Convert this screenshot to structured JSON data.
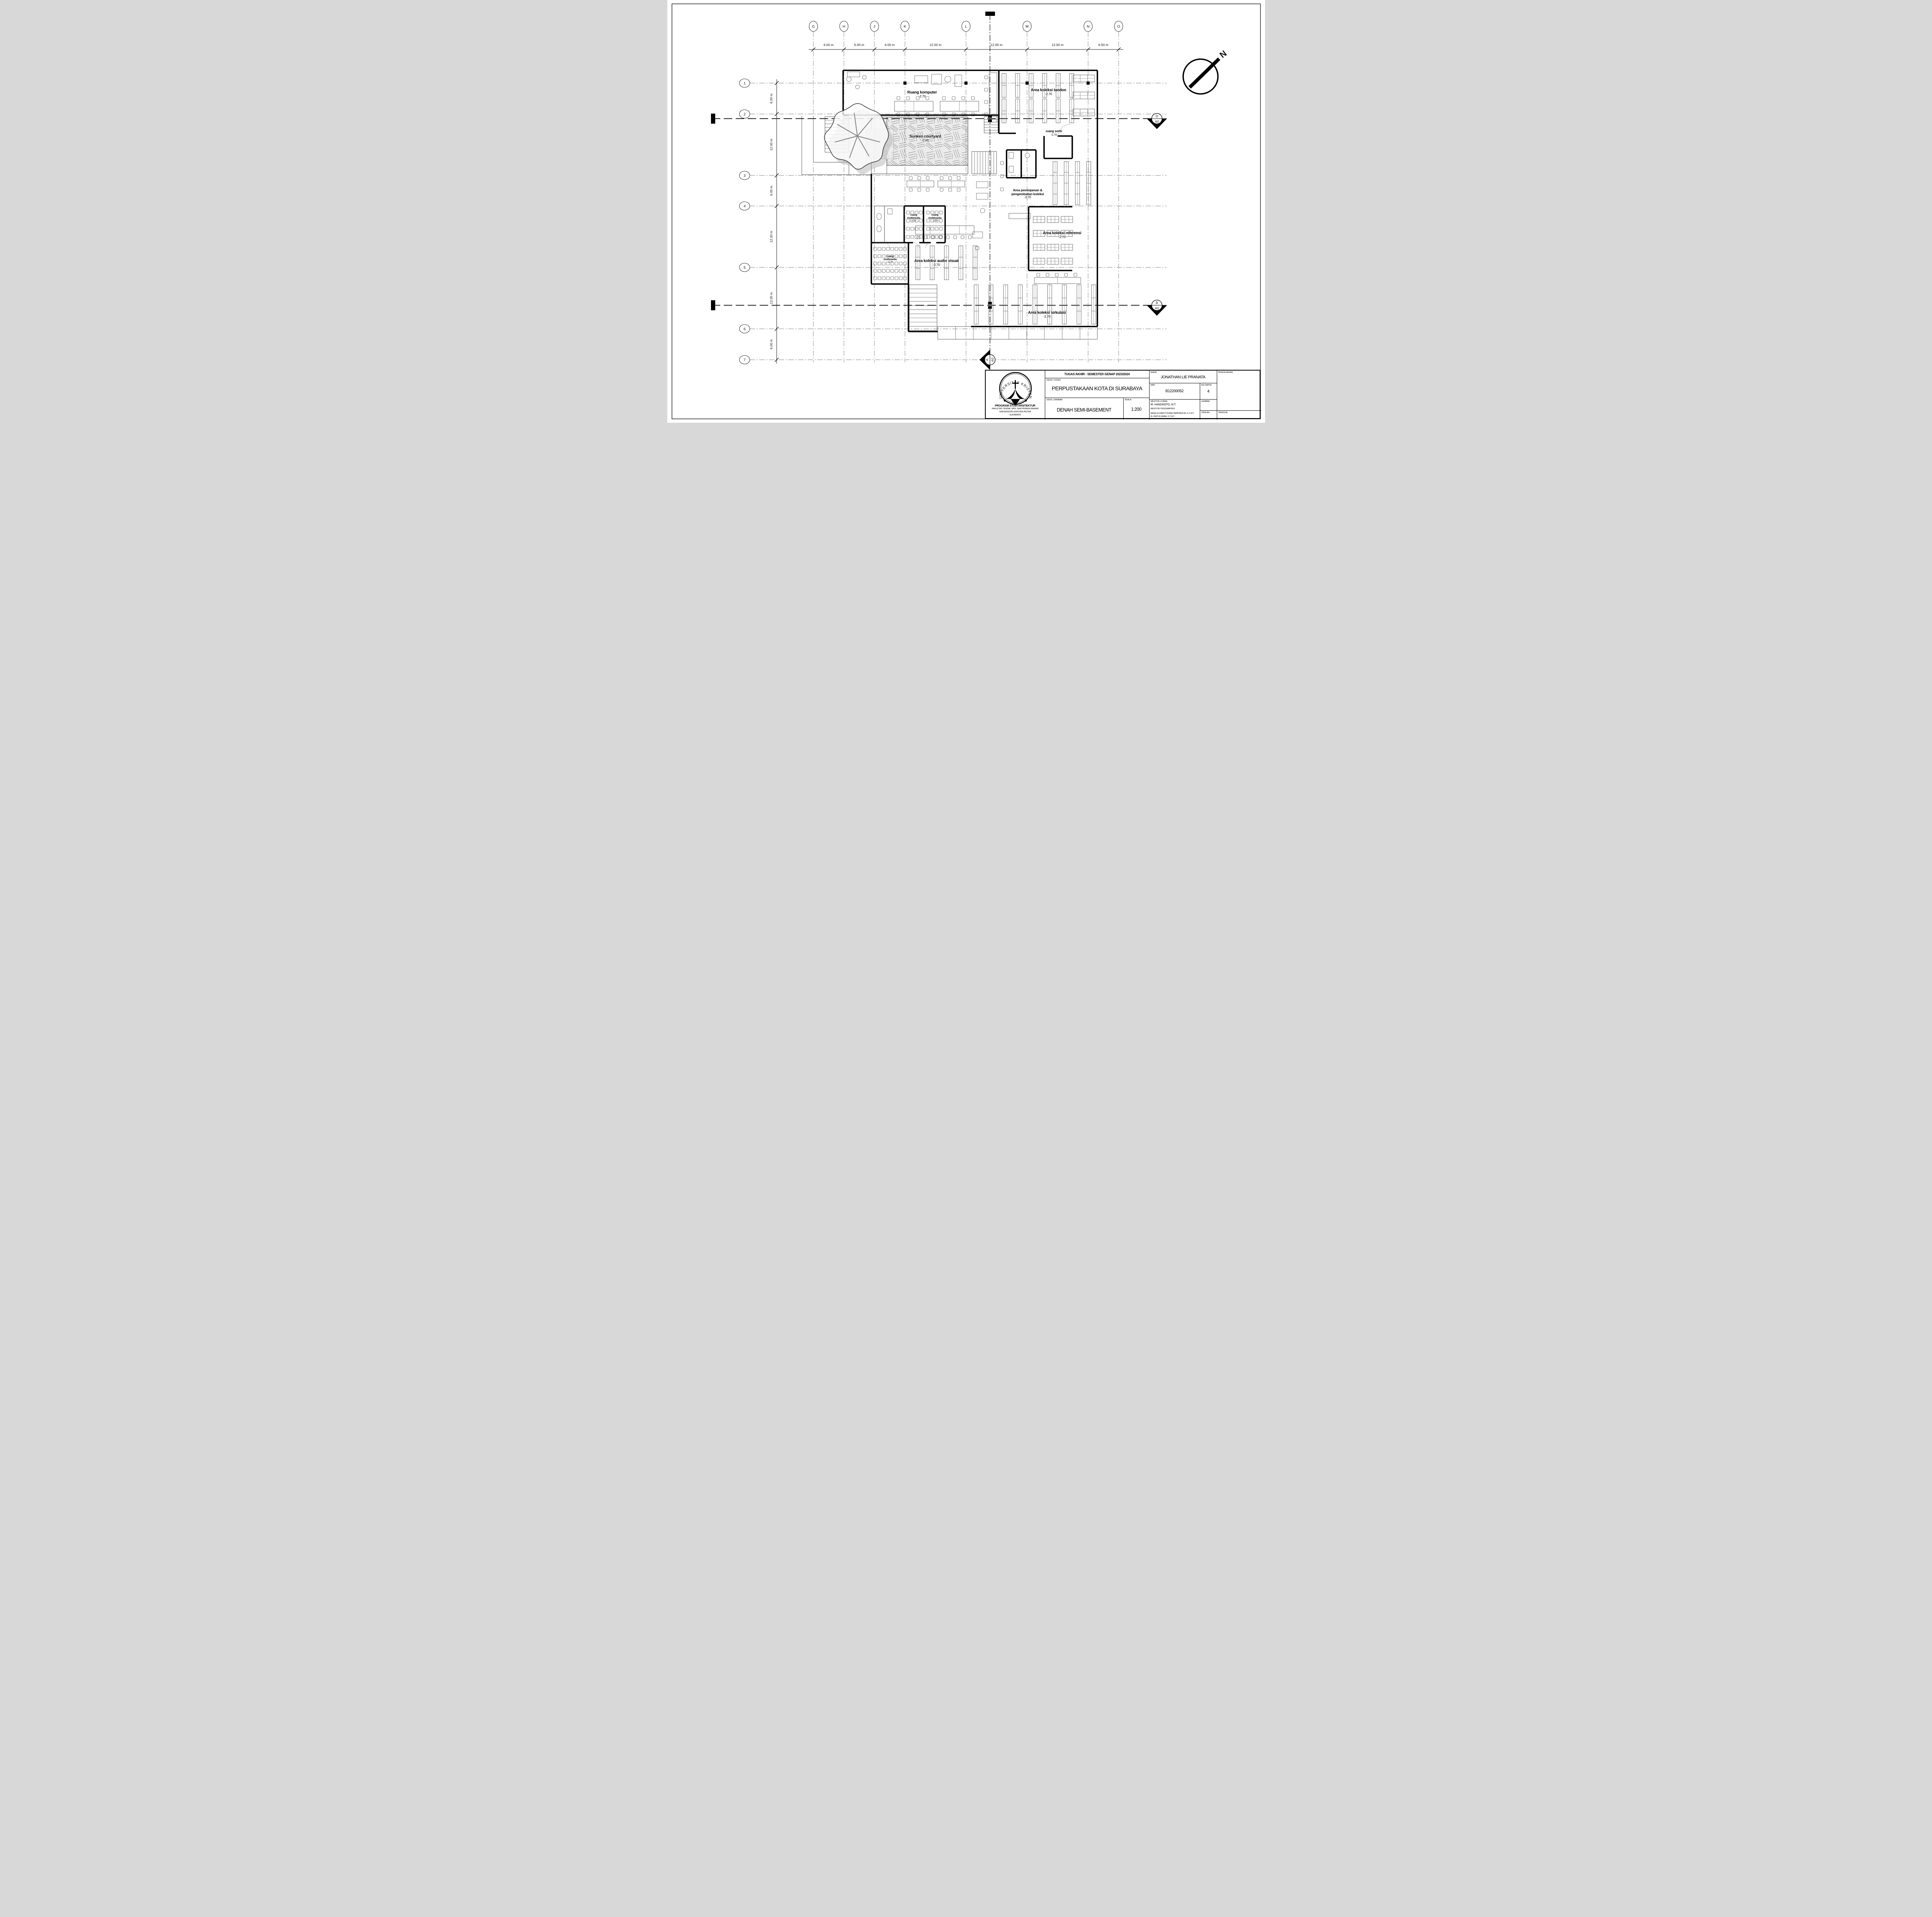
{
  "drawing": {
    "north_label": "N",
    "grid": {
      "columns": [
        "G",
        "H",
        "J",
        "K",
        "L",
        "M",
        "N",
        "O"
      ],
      "column_spans": [
        "6.00 m",
        "6.00 m",
        "6.00 m",
        "12.00 m",
        "12.00 m",
        "12.00 m",
        "6.00 m"
      ],
      "rows": [
        "1",
        "2",
        "3",
        "4",
        "5",
        "6",
        "7"
      ],
      "row_spans": [
        "6.00 m",
        "12.00 m",
        "6.00 m",
        "12.00 m",
        "12.00 m",
        "6.00 m"
      ]
    },
    "rooms": [
      {
        "id": "ruang-komputer",
        "name": "Ruang komputer",
        "level": "-2.70"
      },
      {
        "id": "area-koleksi-tandon",
        "name": "Area koleksi tandon",
        "level": "-2.70"
      },
      {
        "id": "sunken-courtyard",
        "name": "Sunken courtyard",
        "level": "-2.85"
      },
      {
        "id": "ruang-sortir",
        "name": "ruang sortir",
        "level": "-2.70"
      },
      {
        "id": "area-peminjaman",
        "name": "Area peminjaman &\npengembalian koleksi",
        "level": "-2.70"
      },
      {
        "id": "ruang-multimedia-1",
        "name": "ruang\nmultimedia",
        "level": "-2.70"
      },
      {
        "id": "ruang-multimedia-2",
        "name": "ruang\nmultimedia",
        "level": "-2.70"
      },
      {
        "id": "area-koleksi-referensi",
        "name": "Area koleksi referensi",
        "level": "-2.70"
      },
      {
        "id": "ruang-multimedia-3",
        "name": "ruang\nmultimedia",
        "level": "-2.70"
      },
      {
        "id": "area-koleksi-audio-visual",
        "name": "Area koleksi audio visual",
        "level": "-2.70"
      },
      {
        "id": "area-koleksi-sirkulasi",
        "name": "Area koleksi sirkulasi",
        "level": "-2.70"
      }
    ],
    "section_markers": [
      {
        "id": "d",
        "letter": "D",
        "sheet": "A0"
      },
      {
        "id": "b",
        "letter": "B",
        "sheet": "A0"
      },
      {
        "id": "a",
        "letter": "A",
        "sheet": "A0"
      }
    ]
  },
  "title_block": {
    "header": "TUGAS AKHIR - SEMESTER GENAP 2023/2024",
    "labels": {
      "judul_tugas": "JUDUL TUGAS",
      "judul_gambar": "JUDUL GAMBAR",
      "skala": "SKALA",
      "nama": "NAMA",
      "nrp": "NRP",
      "kelompok": "KELOMPOK",
      "mentor_utama": "MENTOR UTAMA",
      "mentor_pendamping": "MENTOR PENDAMPING",
      "lembar": "LEMBAR",
      "jumlah": "JUMLAH",
      "tanggal": "TANGGAL",
      "pengesahan": "PENGESAHAN"
    },
    "judul_tugas": "PERPUSTAKAAN KOTA DI SURABAYA",
    "judul_gambar": "DENAH SEMI-BASEMENT",
    "skala": "1:200",
    "nama": "JONATHAN LIE PRANATA",
    "nrp": "B12200052",
    "kelompok": "4",
    "mentor_utama": "IR. HANDINOTO, M.T.",
    "mentor_pendamping": [
      "ANGELA CHRISTYSONIA TAMPUBOLON, S.T.,M.T.",
      "Dr. FENY ELSIANA, S.T.,M.T."
    ],
    "institution": {
      "logo_text_top": "UNIVERSITAS KRISTEN",
      "logo_text_bottom": "PETRA",
      "lines": [
        "PROGRAM STUDI ARSITEKTUR",
        "FAKULTAS TEKNIK SIPIL DAN PERENCANAAN",
        "UNIVERSITAS KRISTEN PETRA",
        "SURABAYA"
      ]
    }
  }
}
